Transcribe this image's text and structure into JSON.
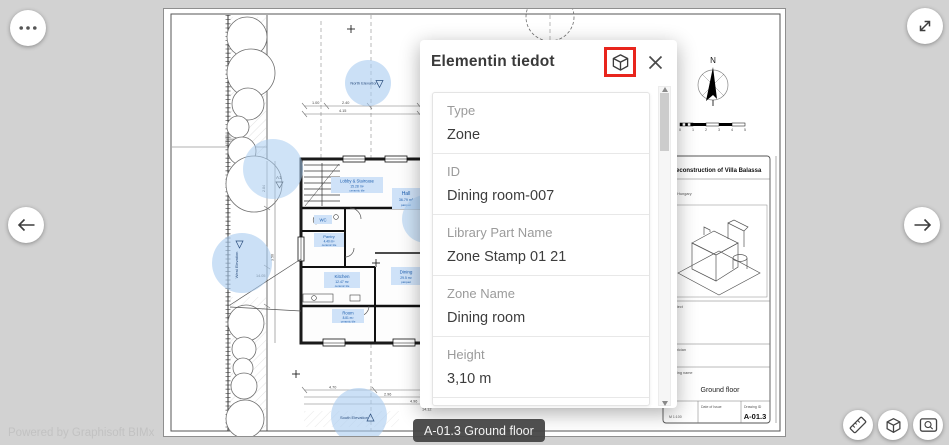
{
  "colors": {
    "accent_red": "#e8251d",
    "zone_fill": "#cfe2f8",
    "zone_text": "#1e5fae",
    "highlight_blue": "#a8ccf0",
    "tooltip_bg": "#464646"
  },
  "viewer": {
    "powered_by": "Powered by Graphisoft BIMx",
    "sheet_tooltip": "A-01.3 Ground floor",
    "icons": {
      "more": "ellipsis-icon",
      "back": "arrow-left-icon",
      "forward": "arrow-right-icon",
      "fullscreen": "expand-icon",
      "measure": "ruler-icon",
      "model3d": "cube-icon",
      "zoom_window": "zoom-rectangle-icon",
      "close": "close-icon"
    }
  },
  "panel": {
    "title": "Elementin tiedot",
    "fields": [
      {
        "label": "Type",
        "value": "Zone"
      },
      {
        "label": "ID",
        "value": "Dining room-007"
      },
      {
        "label": "Library Part Name",
        "value": "Zone Stamp 01 21"
      },
      {
        "label": "Zone Name",
        "value": "Dining room"
      },
      {
        "label": "Height",
        "value": "3,10 m"
      },
      {
        "label": "Calculated Area",
        "value": ""
      }
    ]
  },
  "drawing": {
    "compass": "N",
    "scale_ticks": [
      "0",
      "1",
      "2",
      "3",
      "4",
      "5"
    ],
    "markers": {
      "section": "A1",
      "north": "North Elevation",
      "west": "West Elevation",
      "south": "South Elevation"
    },
    "rooms": [
      {
        "name": "Lobby & Staircase",
        "area": "15.28 m²",
        "finish": "ceramic tile"
      },
      {
        "name": "Hall",
        "area": "36.79 m²",
        "finish": "parquet"
      },
      {
        "name": "WC",
        "area": "",
        "finish": ""
      },
      {
        "name": "Pantry",
        "area": "4.40 m²",
        "finish": "ceramic tile"
      },
      {
        "name": "Kitchen",
        "area": "12.47 m²",
        "finish": "ceramic tile"
      },
      {
        "name": "Dining",
        "area": "29.5 m²",
        "finish": "parquet"
      },
      {
        "name": "Room",
        "area": "8.81 m²",
        "finish": "ceramic tile"
      }
    ],
    "dims": [
      "1.00",
      "2.40",
      "4.15",
      "2.84",
      "3.50",
      "14.05",
      "4.70",
      "2.96",
      "4.96",
      "14.12"
    ],
    "title_block": {
      "project": "Reconstruction of Villa Balassa",
      "project_line1": "1986",
      "project_line2": "pest, Hungary",
      "architect_label": "Architect",
      "technician_label": "Technician",
      "drawing_name_label": "Drawing name",
      "drawing_name": "Ground floor",
      "scale": "M 1:100",
      "date_label": "Date of Issue",
      "id_label": "Drawing ID",
      "drawing_id": "A-01.3"
    }
  }
}
